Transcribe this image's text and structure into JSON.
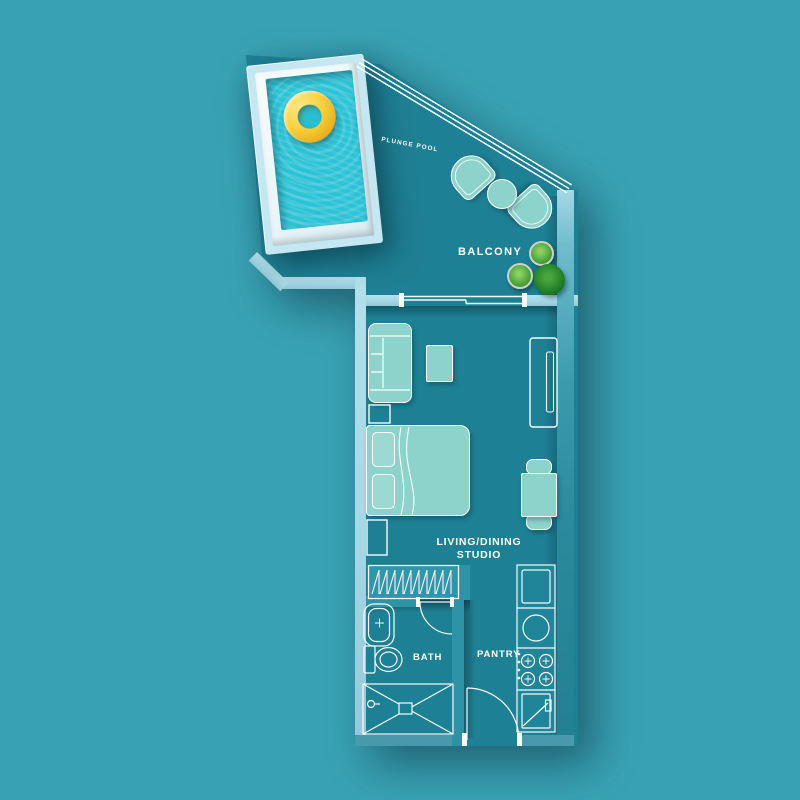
{
  "labels": {
    "plunge_pool": "PLUNGE POOL",
    "balcony": "BALCONY",
    "living_dining": "LIVING/DINING",
    "studio": "STUDIO",
    "bath": "BATH",
    "pantry": "PANTRY"
  },
  "colors": {
    "background": "#38a2b4",
    "floor": "#1e8094",
    "wall_light": "#aadcea",
    "wall_medium": "#2e93a6",
    "pool_frame": "#c4e7f2",
    "pool_deck": "#eef8fb",
    "pool_water": "#2cc3d6",
    "pool_ring": "#f3c42f",
    "furniture_fill": "#8ed2cc",
    "linework": "#ffffff",
    "plant_green": "#4ba33c",
    "plant_dark_green": "#1f7a22"
  },
  "rooms": [
    {
      "name": "Plunge Pool",
      "furniture": [
        "pool-ring-float"
      ]
    },
    {
      "name": "Balcony",
      "furniture": [
        "lounge-chair",
        "round-table",
        "lounge-chair",
        "potted-plant",
        "potted-plant",
        "potted-plant"
      ]
    },
    {
      "name": "Living/Dining Studio",
      "furniture": [
        "sofa",
        "coffee-table",
        "closet",
        "double-bed",
        "pillow",
        "pillow",
        "nightstand",
        "dresser",
        "wardrobe-hangers",
        "dining-table",
        "dining-chair",
        "dining-chair",
        "sliding-door"
      ]
    },
    {
      "name": "Bath",
      "furniture": [
        "sink",
        "toilet",
        "shower",
        "door"
      ]
    },
    {
      "name": "Pantry",
      "furniture": [
        "refrigerator",
        "kitchen-sink",
        "stove-4-burner",
        "oven",
        "entrance-door"
      ]
    }
  ]
}
